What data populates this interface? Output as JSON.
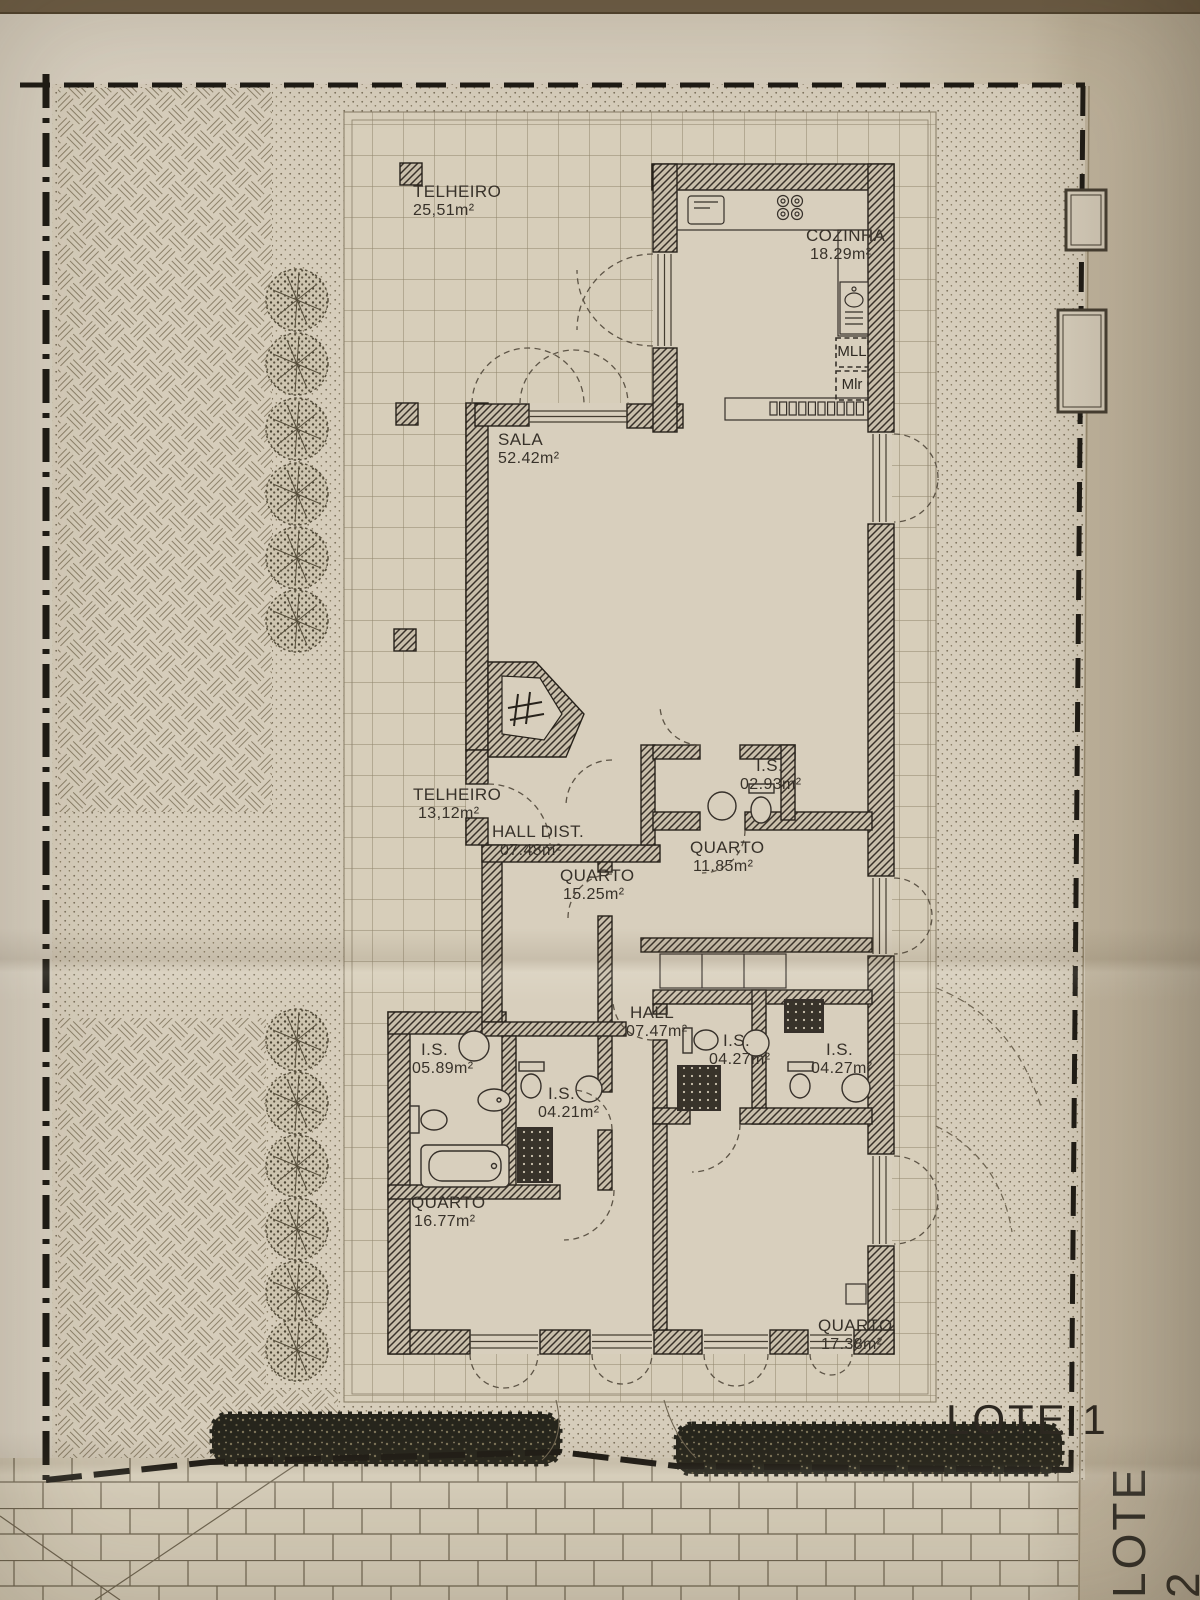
{
  "document": {
    "lot_label_primary": "LOTE 1",
    "lot_label_secondary": "LOTE 2"
  },
  "rooms": [
    {
      "name": "TELHEIRO",
      "area": "25,51m²"
    },
    {
      "name": "COZINHA",
      "area": "18.29m²"
    },
    {
      "name": "SALA",
      "area": "52.42m²"
    },
    {
      "name": "TELHEIRO",
      "area": "13,12m²"
    },
    {
      "name": "HALL DIST.",
      "area": "07.48m²"
    },
    {
      "name": "I.S.",
      "area": "02.93m²"
    },
    {
      "name": "QUARTO",
      "area": "11.85m²"
    },
    {
      "name": "QUARTO",
      "area": "15.25m²"
    },
    {
      "name": "HALL",
      "area": "07.47m²"
    },
    {
      "name": "I.S.",
      "area": "04.27m²"
    },
    {
      "name": "I.S.",
      "area": "04.27m²"
    },
    {
      "name": "I.S.",
      "area": "05.89m²"
    },
    {
      "name": "I.S.",
      "area": "04.21m²"
    },
    {
      "name": "QUARTO",
      "area": "16.77m²"
    },
    {
      "name": "QUARTO",
      "area": "17.38m²"
    }
  ],
  "appliances": {
    "washing_machine": "MLL",
    "dryer": "Mlr"
  },
  "colors": {
    "paper": "#d6cdbb",
    "ink": "#3a342c",
    "wall": "#2a251d"
  }
}
